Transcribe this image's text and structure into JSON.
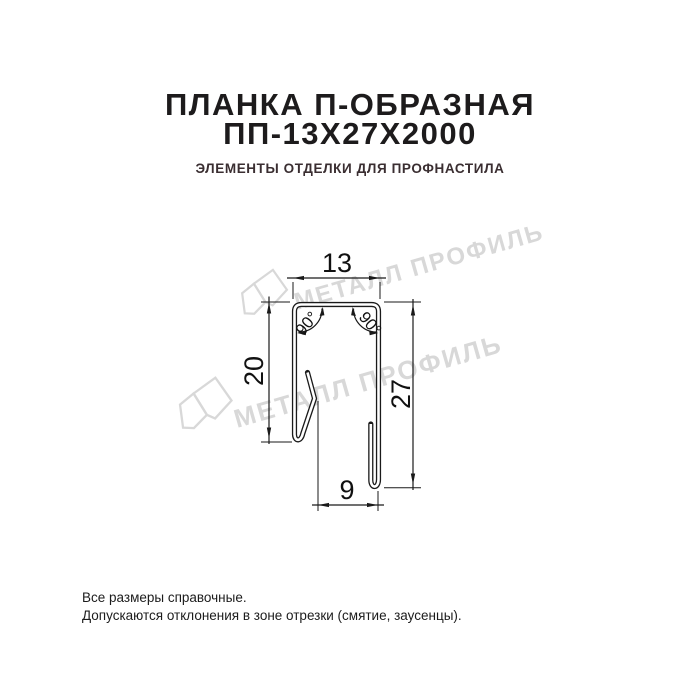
{
  "header": {
    "title_line1": "ПЛАНКА П-ОБРАЗНАЯ",
    "title_line2": "ПП-13Х27Х2000",
    "subtitle": "ЭЛЕМЕНТЫ ОТДЕЛКИ ДЛЯ ПРОФНАСТИЛА"
  },
  "drawing": {
    "type": "technical-cross-section",
    "product": "U-shaped strip profile",
    "dim_top_width": "13",
    "dim_left_height": "20",
    "dim_right_height": "27",
    "dim_bottom_width": "9",
    "angle_left": "90°",
    "angle_right": "90°"
  },
  "watermark": {
    "text": "МЕТАЛЛ ПРОФИЛЬ",
    "color": "#d8d8d8"
  },
  "footer": {
    "line1": "Все размеры справочные.",
    "line2": "Допускаются отклонения в зоне отрезки (смятие, заусенцы)."
  },
  "colors": {
    "background": "#ffffff",
    "line": "#1a1a1a",
    "title": "#1d1b1c",
    "subtitle": "#3a2e31"
  }
}
